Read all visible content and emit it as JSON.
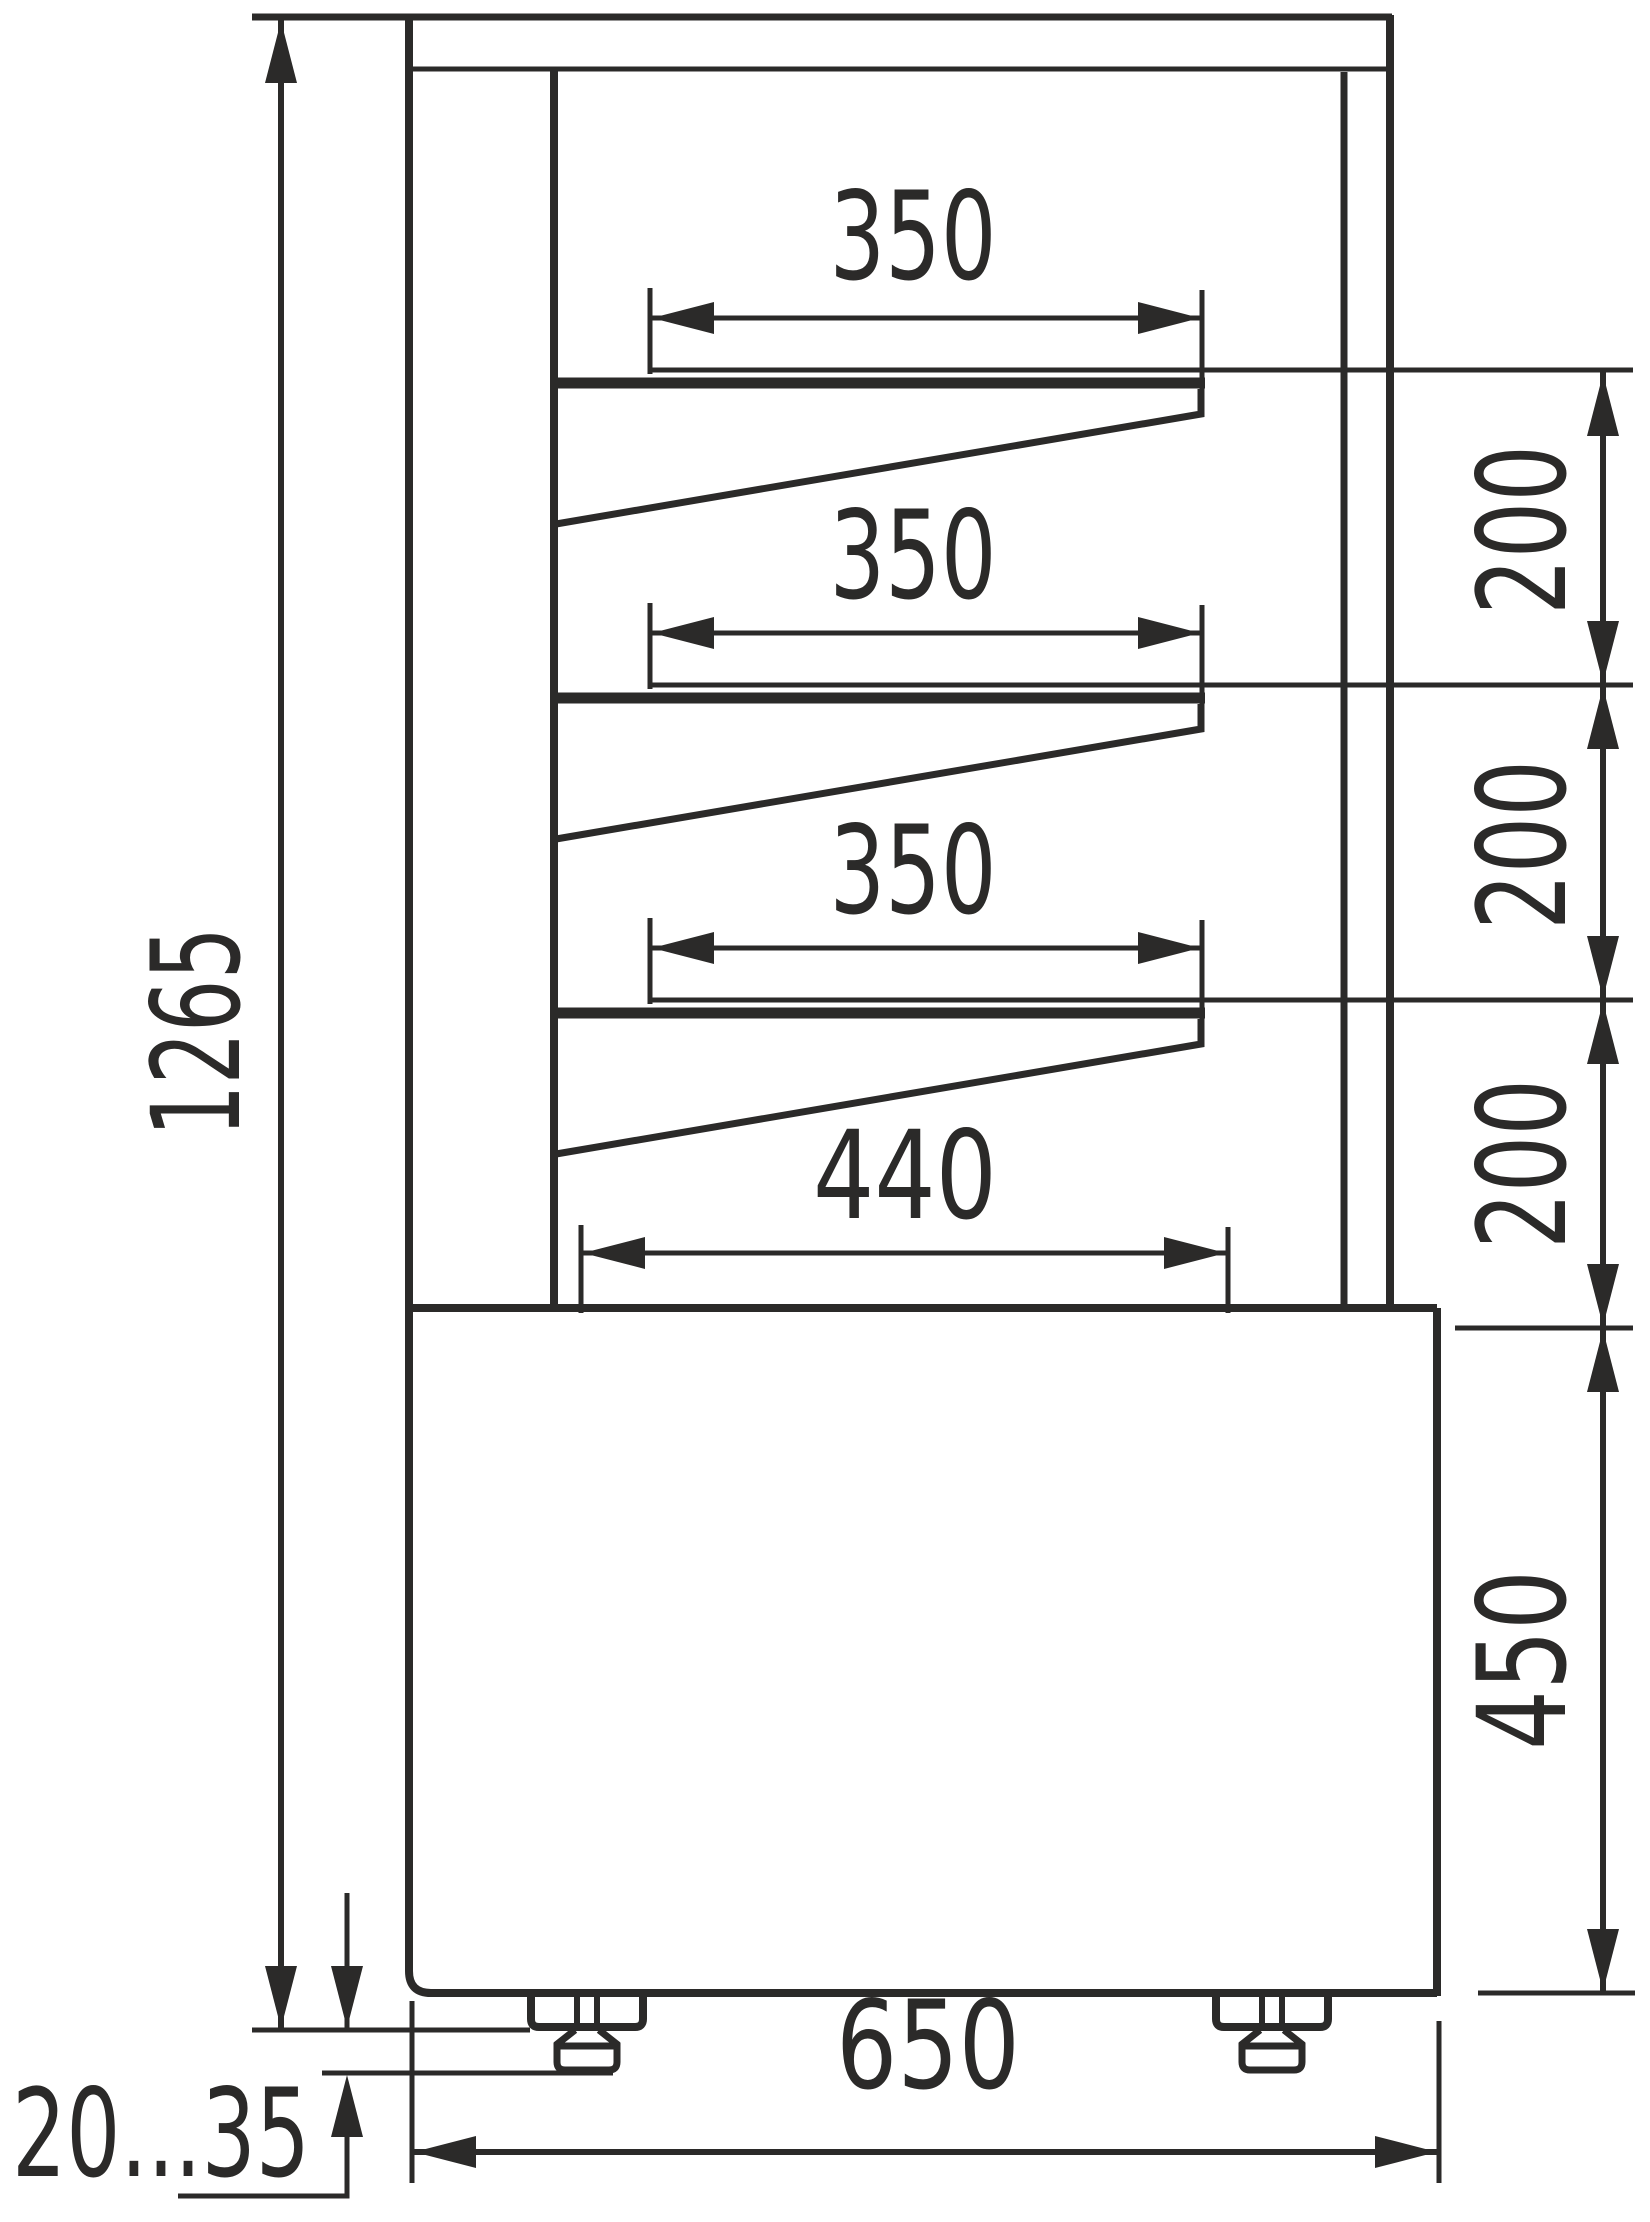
{
  "drawing": {
    "type": "technical-dimension-drawing",
    "subject": "refrigerated-display-case-side-view",
    "colors": {
      "line": "#2b2a29",
      "background": "#ffffff"
    },
    "labels": {
      "overall_height": "1265",
      "shelf_depth_1": "350",
      "shelf_depth_2": "350",
      "shelf_depth_3": "350",
      "bottom_shelf_depth": "440",
      "shelf_spacing_1": "200",
      "shelf_spacing_2": "200",
      "shelf_spacing_3": "200",
      "base_height": "450",
      "overall_depth": "650",
      "foot_adjustment_range": "20...35"
    }
  }
}
